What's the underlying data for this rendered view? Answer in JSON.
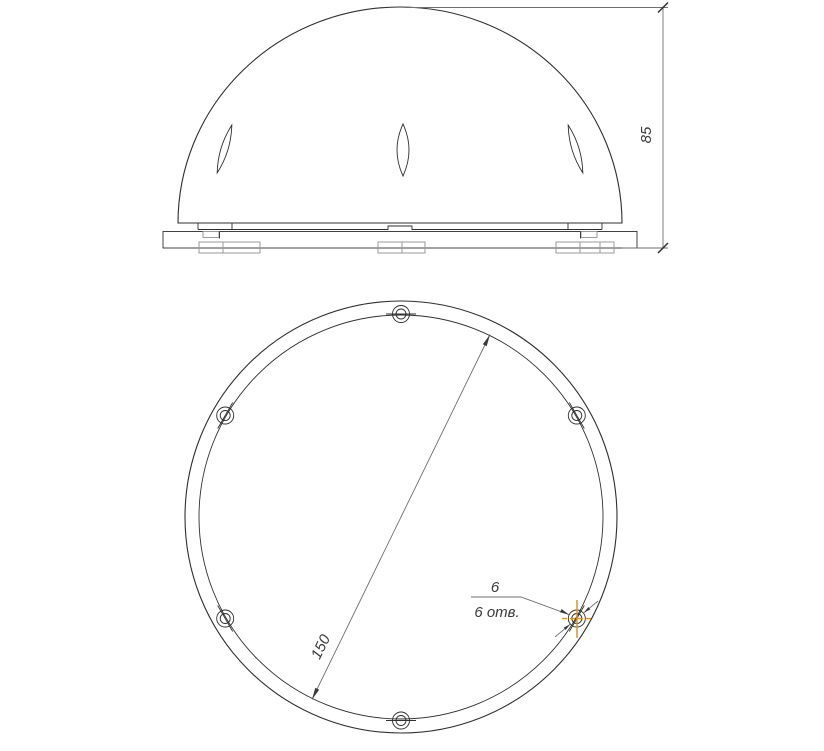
{
  "views": {
    "front": {
      "height_dimension": "85"
    },
    "plan": {
      "bolt_circle_diameter": "150",
      "hole_callout": {
        "diameter": "6",
        "count_label": "6 отв."
      }
    }
  },
  "colors": {
    "background": "#ffffff",
    "geometry_line": "#2f2f2f",
    "dimension_line": "#6e6e6e",
    "detail_line": "#9a9a9a",
    "selection_highlight": "#de9226"
  }
}
